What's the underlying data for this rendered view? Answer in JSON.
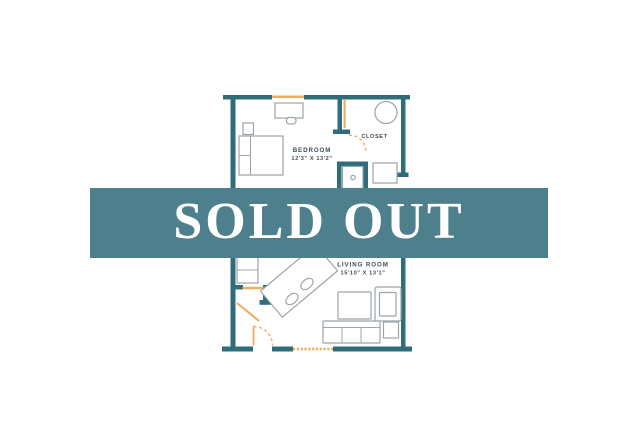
{
  "banner": {
    "label": "SOLD OUT"
  },
  "floor_plan": {
    "rooms": {
      "bedroom": {
        "name": "BEDROOM",
        "dimensions": "12'3\" X 13'2\""
      },
      "closet": {
        "name": "CLOSET"
      },
      "living_room": {
        "name": "LIVING ROOM",
        "dimensions": "15'10\" X 13'1\""
      }
    }
  },
  "colors": {
    "background": "#ffffff",
    "wall": "#2f6d7b",
    "banner": "#4d7f8d",
    "banner-text": "#ffffff",
    "accent": "#f0ad5c",
    "furniture": "#9ba4a9",
    "label-text": "#3d4d55"
  }
}
